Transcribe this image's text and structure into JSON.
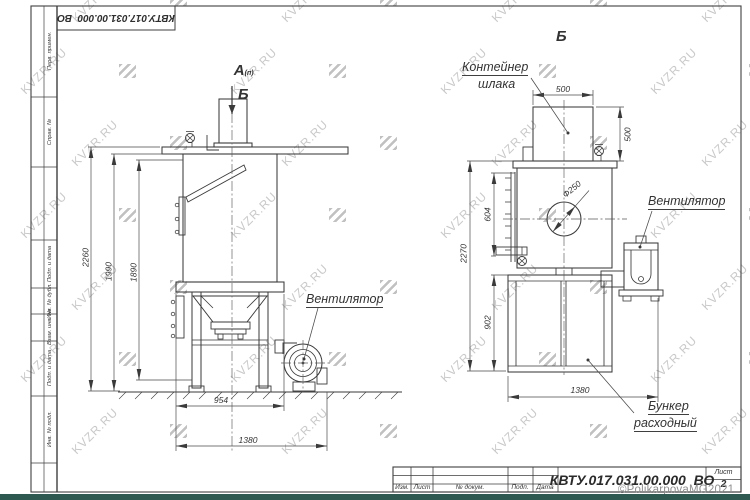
{
  "watermark": {
    "text": "KVZR.RU"
  },
  "frame": {
    "stamp_rotated": "КВТУ.017.031.00.000  ВО",
    "margin_fields": [
      "Перв. примен.",
      "Справ. №",
      "Подп. и дата",
      "Инв. № дубл.",
      "Взам. инв. №",
      "Подп. и дата",
      "Инв. № подл."
    ]
  },
  "title_block": {
    "columns": [
      "Изм.",
      "Лист",
      "№ докум.",
      "Подп.",
      "Дата"
    ],
    "doc_number": "КВТУ.017.031.00.000  ВО",
    "sheet_label": "Лист",
    "sheet_number": "2"
  },
  "views": {
    "left": {
      "label": "А",
      "label_sub": "(п)",
      "section_mark": "Б",
      "fan_label": "Вентилятор",
      "dims": {
        "d2260": "2260",
        "d1990": "1990",
        "d1890": "1890",
        "d954": "954",
        "d1380": "1380"
      }
    },
    "right": {
      "label": "Б",
      "container_line1": "Контейнер",
      "container_line2": "шлака",
      "fan_label": "Вентилятор",
      "bunker_line1": "Бункер",
      "bunker_line2": "расходный",
      "dims": {
        "d500w": "500",
        "d500h": "500",
        "d2270": "2270",
        "d604": "604",
        "d902": "902",
        "d1380": "1380",
        "dia": "Ф250"
      }
    }
  },
  "copyright": "©PolikarpovaMG2021"
}
